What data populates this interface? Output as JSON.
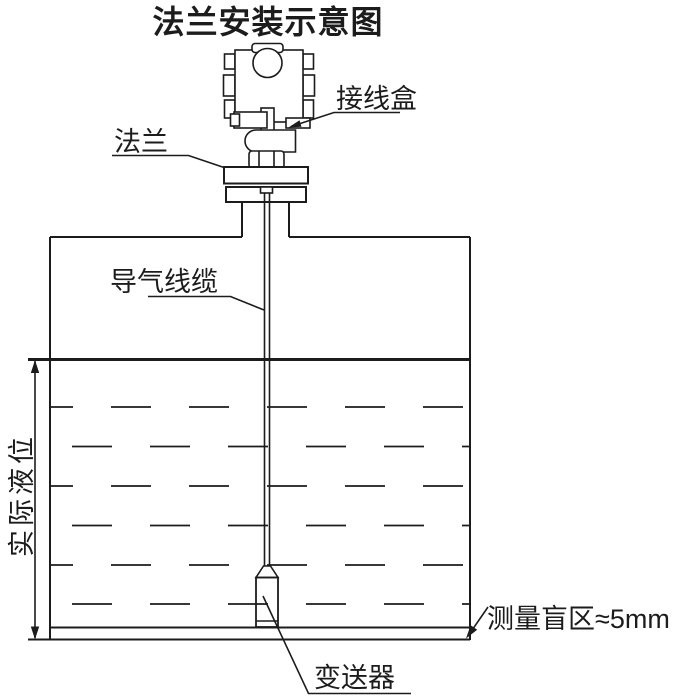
{
  "title": "法兰安装示意图",
  "annotations": {
    "junction_box": "接线盒",
    "flange": "法兰",
    "air_cable": "导气线缆",
    "actual_level": "实际液位",
    "transmitter": "变送器",
    "blind_zone": "测量盲区≈5mm"
  },
  "colors": {
    "line": "#1c1c1c",
    "background": "#ffffff"
  }
}
